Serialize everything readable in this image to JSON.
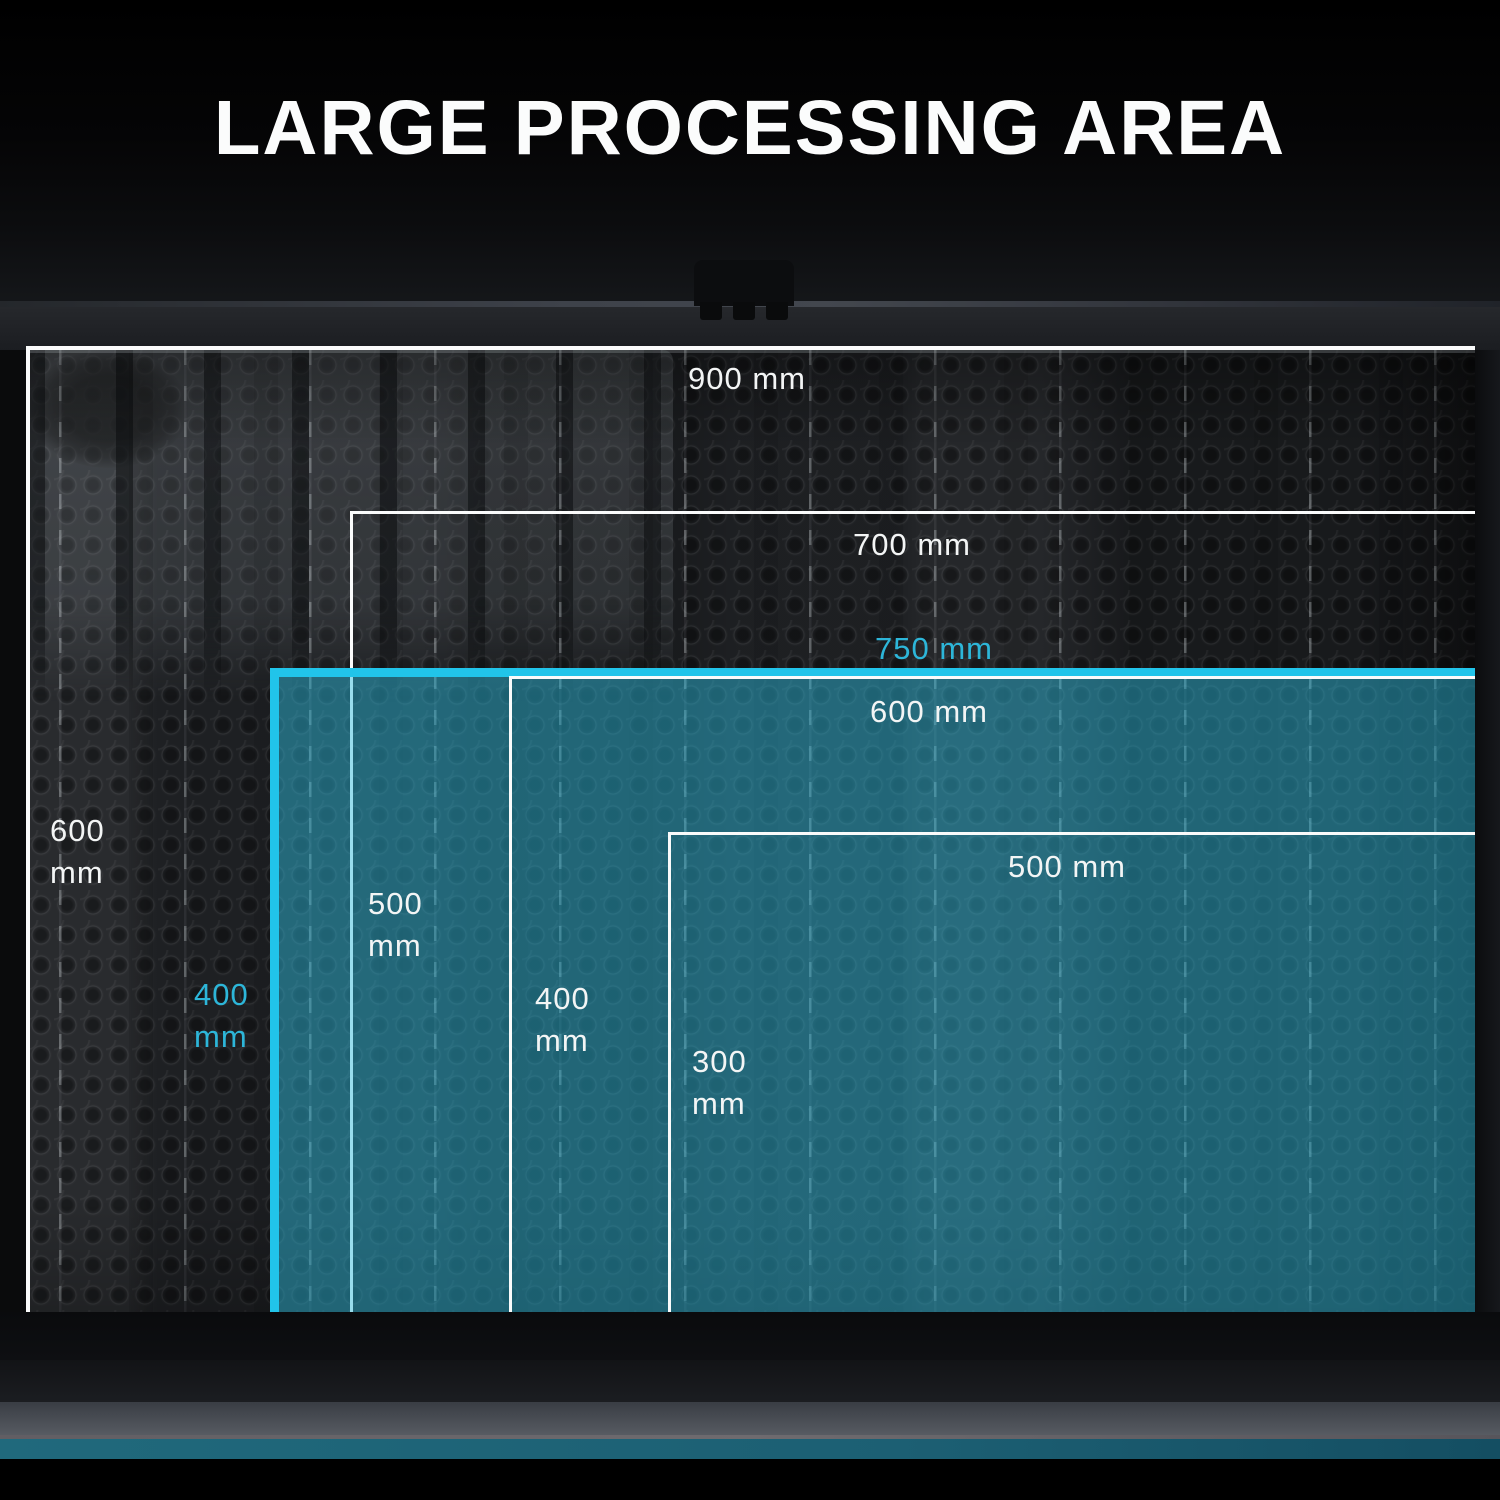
{
  "title": "LARGE PROCESSING AREA",
  "unit": "mm",
  "colors": {
    "accent_border_cyan": "#21c4ea",
    "accent_text_cyan": "#2db6d9",
    "label_white": "#f3f5f5",
    "teal_fill": "rgba(45,188,220,0.47)",
    "bottom_accent_strip": "#1d6074"
  },
  "areas": [
    {
      "name": "area-900x600",
      "width_label": "900 mm",
      "height_label": "600 mm",
      "width_mm": 900,
      "height_mm": 600,
      "highlight": false
    },
    {
      "name": "area-700x500",
      "width_label": "700 mm",
      "height_label": "500 mm",
      "width_mm": 700,
      "height_mm": 500,
      "highlight": false
    },
    {
      "name": "area-750x400",
      "width_label": "750 mm",
      "height_label": "400 mm",
      "width_mm": 750,
      "height_mm": 400,
      "highlight": true
    },
    {
      "name": "area-600x400",
      "width_label": "600 mm",
      "height_label": "400 mm",
      "width_mm": 600,
      "height_mm": 400,
      "highlight": false
    },
    {
      "name": "area-500x300",
      "width_label": "500 mm",
      "height_label": "300 mm",
      "width_mm": 500,
      "height_mm": 300,
      "highlight": false
    }
  ]
}
